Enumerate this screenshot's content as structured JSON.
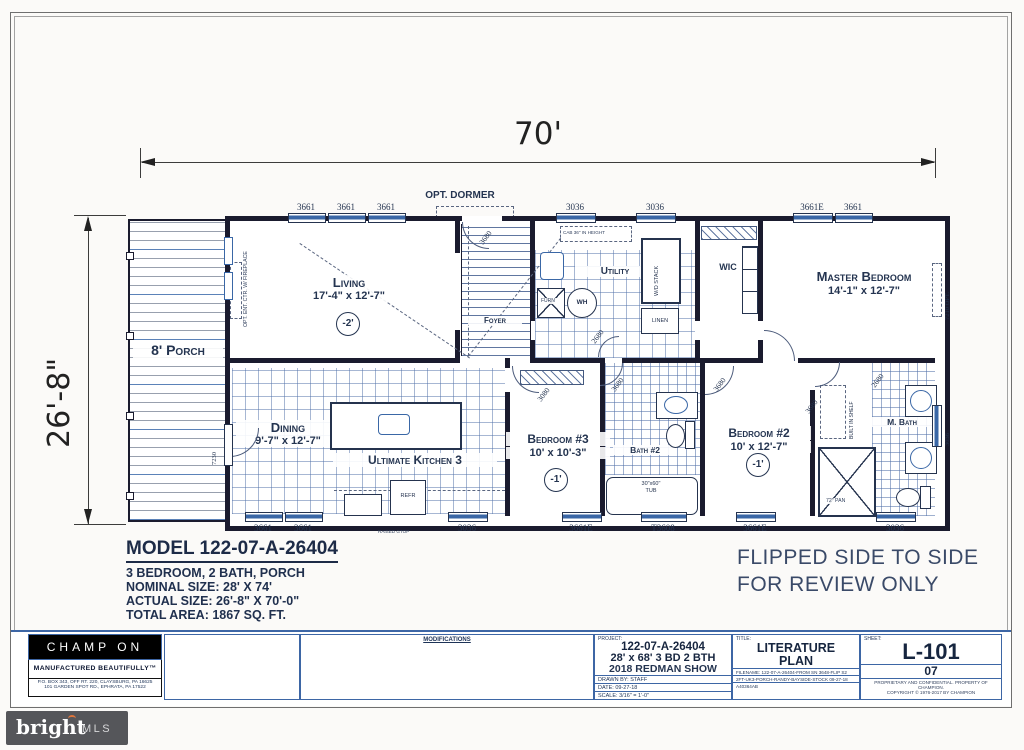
{
  "dimensions": {
    "width": "70'",
    "height": "26'-8\""
  },
  "annotations": {
    "opt_dormer": "OPT. DORMER",
    "flipped_line1": "FLIPPED SIDE TO SIDE",
    "flipped_line2": "FOR REVIEW ONLY"
  },
  "rooms": {
    "porch": {
      "name": "8' Porch"
    },
    "living": {
      "name": "Living",
      "size": "17'-4\" x 12'-7\"",
      "ceiling": "-2'"
    },
    "foyer": {
      "name": "Foyer"
    },
    "utility": {
      "name": "Utility"
    },
    "wic": {
      "name": "WIC"
    },
    "master": {
      "name": "Master Bedroom",
      "size": "14'-1\" x 12'-7\""
    },
    "dining": {
      "name": "Dining",
      "size": "9'-7\" x 12'-7\""
    },
    "kitchen": {
      "name": "Ultimate Kitchen 3"
    },
    "bed3": {
      "name": "Bedroom #3",
      "size": "10' x 10'-3\"",
      "ceiling": "-1'"
    },
    "bath2": {
      "name": "Bath #2"
    },
    "bed2": {
      "name": "Bedroom #2",
      "size": "10' x 12'-7\"",
      "ceiling": "-1'"
    },
    "mbath": {
      "name": "M. Bath"
    }
  },
  "fixtures": {
    "furnace": "FURN",
    "water_heater": "WH",
    "wd_stack": "W/D STACK",
    "linen": "LINEN",
    "fridge": "REFR",
    "tub_size": "30\"x60\"",
    "tub": "TUB",
    "shower_pan": "72\" PAN",
    "built_in_shelf": "BUILT IN SHELF",
    "ent_ctr": "OPT. ENT. CTR. W/ FIREPLACE",
    "cab_note": "CAB 36\" IN HEIGHT",
    "range_note": "RAISED GTOP"
  },
  "windows": {
    "top": [
      "3661",
      "3661",
      "3661",
      "3036",
      "3036",
      "3661E",
      "3661"
    ],
    "bottom": [
      "3661",
      "3661",
      "3036",
      "3661E",
      "T3608",
      "3661E",
      "3036"
    ],
    "right_door": "7210 OPT.",
    "right_window": "3036"
  },
  "door_labels": {
    "stairs": "3680",
    "bed3": "3080",
    "bath2": "3680",
    "bed2": "3680",
    "bed2b": "3680",
    "utility": "2680",
    "mbath": "2680",
    "porch": "7230"
  },
  "model_block": {
    "title": "MODEL 122-07-A-26404",
    "line1": "3 BEDROOM, 2 BATH, PORCH",
    "line2": "NOMINAL SIZE: 28' X 74'",
    "line3": "ACTUAL SIZE: 26'-8\" X 70'-0\"",
    "line4": "TOTAL AREA: 1867 SQ. FT."
  },
  "title_block": {
    "company": {
      "name": "CHAMP ON",
      "tagline": "MANUFACTURED BEAUTIFULLY™",
      "address1": "P.O. BOX 343, OFF RT. 220, CLAYSBURG, PA 16625",
      "address2": "101 GARDEN SPOT RD., EPHRATA, PA 17522"
    },
    "modifications_label": "MODIFICATIONS",
    "project": {
      "label": "PROJECT:",
      "number": "122-07-A-26404",
      "desc": "28' x 68' 3 BD 2 BTH",
      "show": "2018 REDMAN SHOW",
      "drawn_by": "DRAWN BY: STAFF",
      "date": "DATE: 09-27-18",
      "scale": "SCALE: 3/16\" = 1'-0\""
    },
    "title": {
      "label": "TITLE:",
      "line1": "LITERATURE",
      "line2": "PLAN",
      "filename_label": "FILENAME:",
      "filename1": "122-07-A-26404-FROM SN 3648-FLIP S2",
      "filename2": "2FT-UK3-PORCH-RANDY-BAYSIDE-STOCK 09-27-18",
      "code": "A40364AB"
    },
    "sheet": {
      "label": "SHEET:",
      "number": "L-101",
      "page": "07",
      "fineprint1": "PROPRIETARY AND CONFIDENTIAL. PROPERTY OF CHAMPION.",
      "fineprint2": "COPYRIGHT © 1976-2017 BY CHAMPION"
    }
  },
  "watermark": {
    "brand": "bright",
    "suffix": "MLS"
  }
}
